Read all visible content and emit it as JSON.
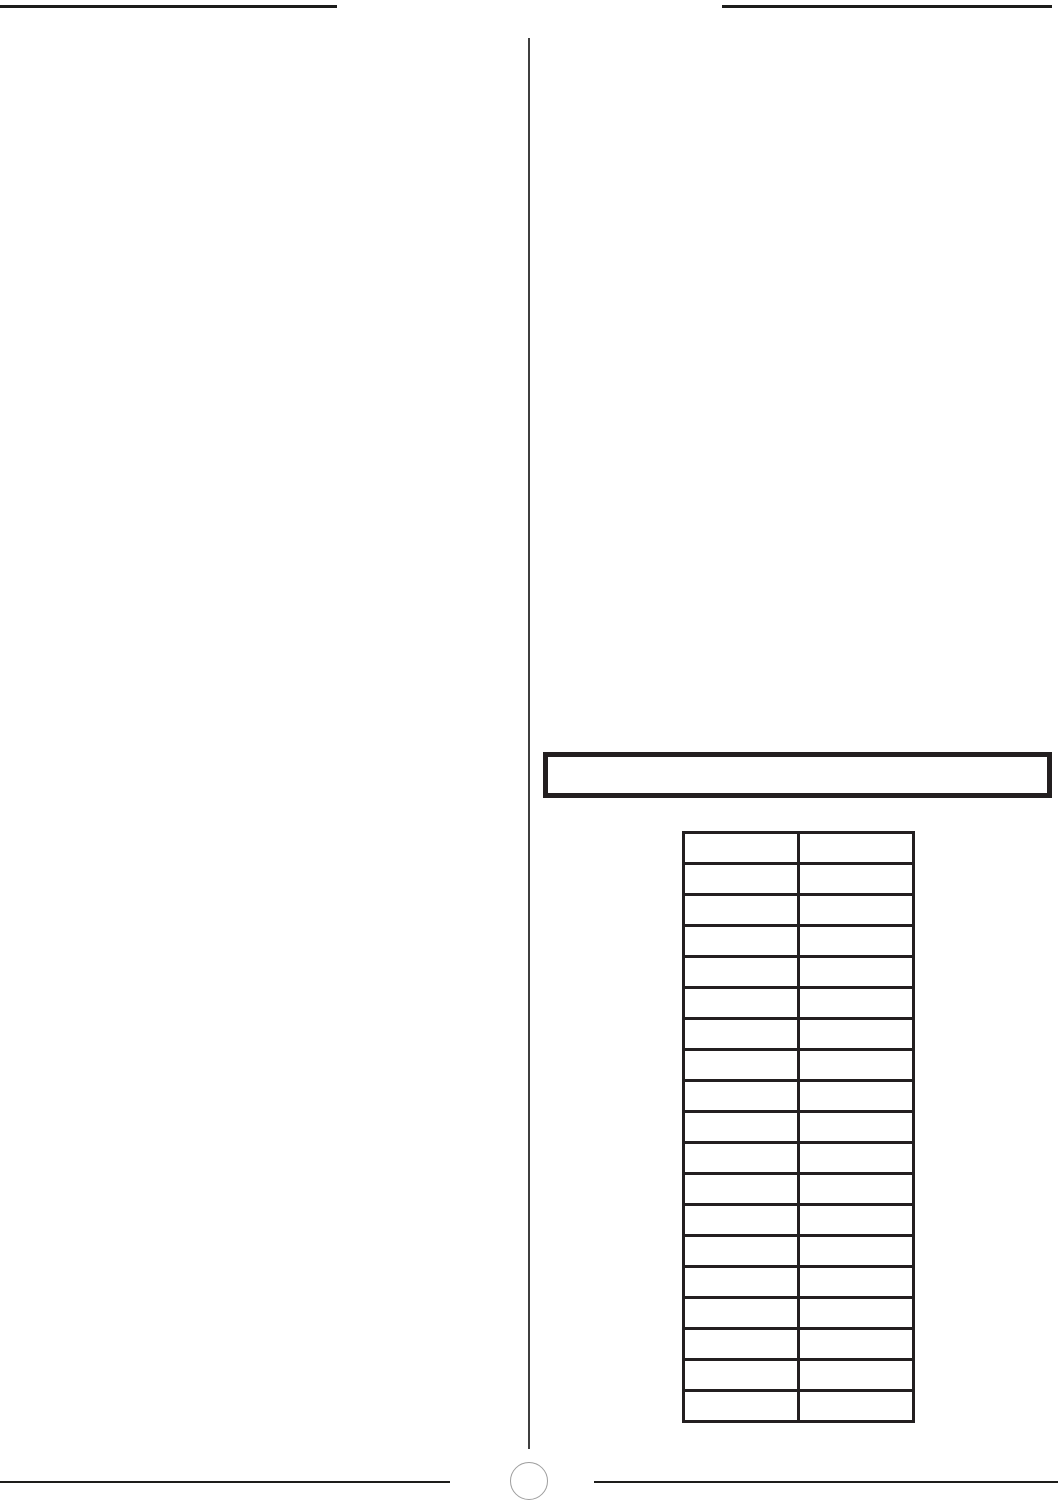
{
  "page": {
    "background_color": "#ffffff",
    "ink_color": "#231f20",
    "divider_color": "#3f3f3f",
    "circle_stroke_color": "#9e9e9e",
    "description": "Blank scanned manual page with empty notes table"
  },
  "header": {
    "left_rule": "",
    "right_rule": ""
  },
  "callout_box": {
    "text": ""
  },
  "table": {
    "row_count": 19,
    "column_count": 2,
    "column_headers": [
      "",
      ""
    ],
    "cells": [
      [
        "",
        ""
      ],
      [
        "",
        ""
      ],
      [
        "",
        ""
      ],
      [
        "",
        ""
      ],
      [
        "",
        ""
      ],
      [
        "",
        ""
      ],
      [
        "",
        ""
      ],
      [
        "",
        ""
      ],
      [
        "",
        ""
      ],
      [
        "",
        ""
      ],
      [
        "",
        ""
      ],
      [
        "",
        ""
      ],
      [
        "",
        ""
      ],
      [
        "",
        ""
      ],
      [
        "",
        ""
      ],
      [
        "",
        ""
      ],
      [
        "",
        ""
      ],
      [
        "",
        ""
      ],
      [
        "",
        ""
      ]
    ]
  },
  "footer": {
    "page_number": ""
  }
}
